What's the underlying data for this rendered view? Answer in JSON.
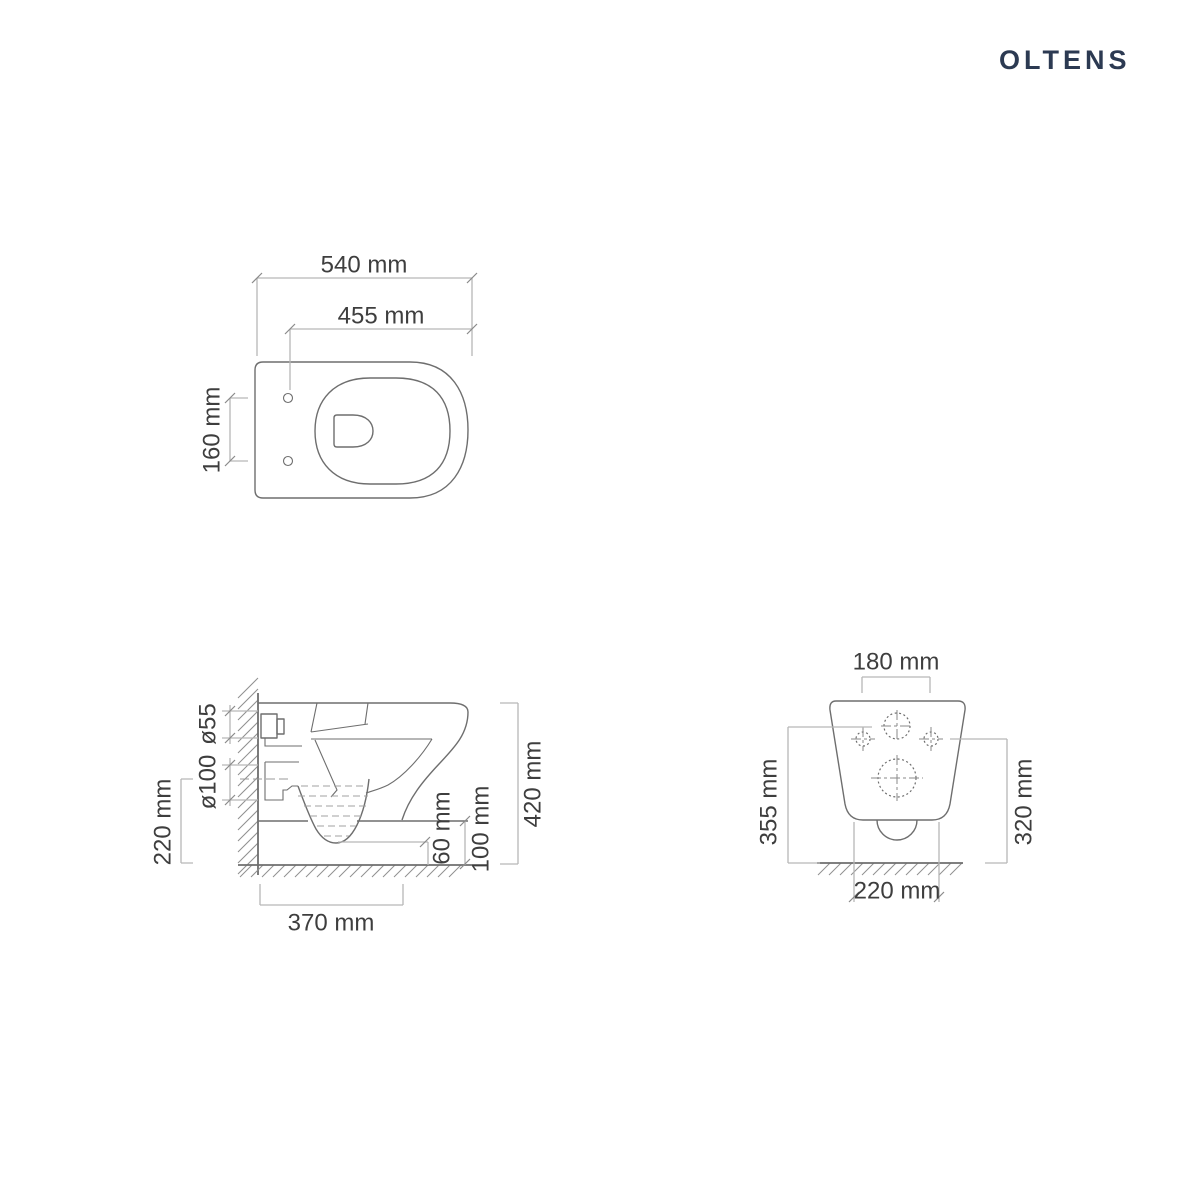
{
  "logo": {
    "text": "OLTENS"
  },
  "colors": {
    "logo_navy": "#2c3a52",
    "drawing_outline": "#6e6e6e",
    "dimension_lines": "#b6b6b6",
    "dimension_text": "#3e3e3e",
    "background": "#ffffff"
  },
  "top_view": {
    "dim_overall_length": "540 mm",
    "dim_seat_length": "455 mm",
    "dim_hinge_hole_spacing": "160 mm"
  },
  "side_view": {
    "dim_inlet_diameter": "ø55",
    "dim_outlet_diameter": "ø100",
    "dim_outlet_center_height": "220 mm",
    "dim_total_height": "420 mm",
    "dim_trap_floor_clearance": "60 mm",
    "dim_rim_floor_clearance": "100 mm",
    "dim_body_depth": "370 mm"
  },
  "back_view": {
    "dim_bolt_spacing": "180 mm",
    "dim_height_left": "355 mm",
    "dim_height_right": "320 mm",
    "dim_base_width": "220 mm"
  }
}
